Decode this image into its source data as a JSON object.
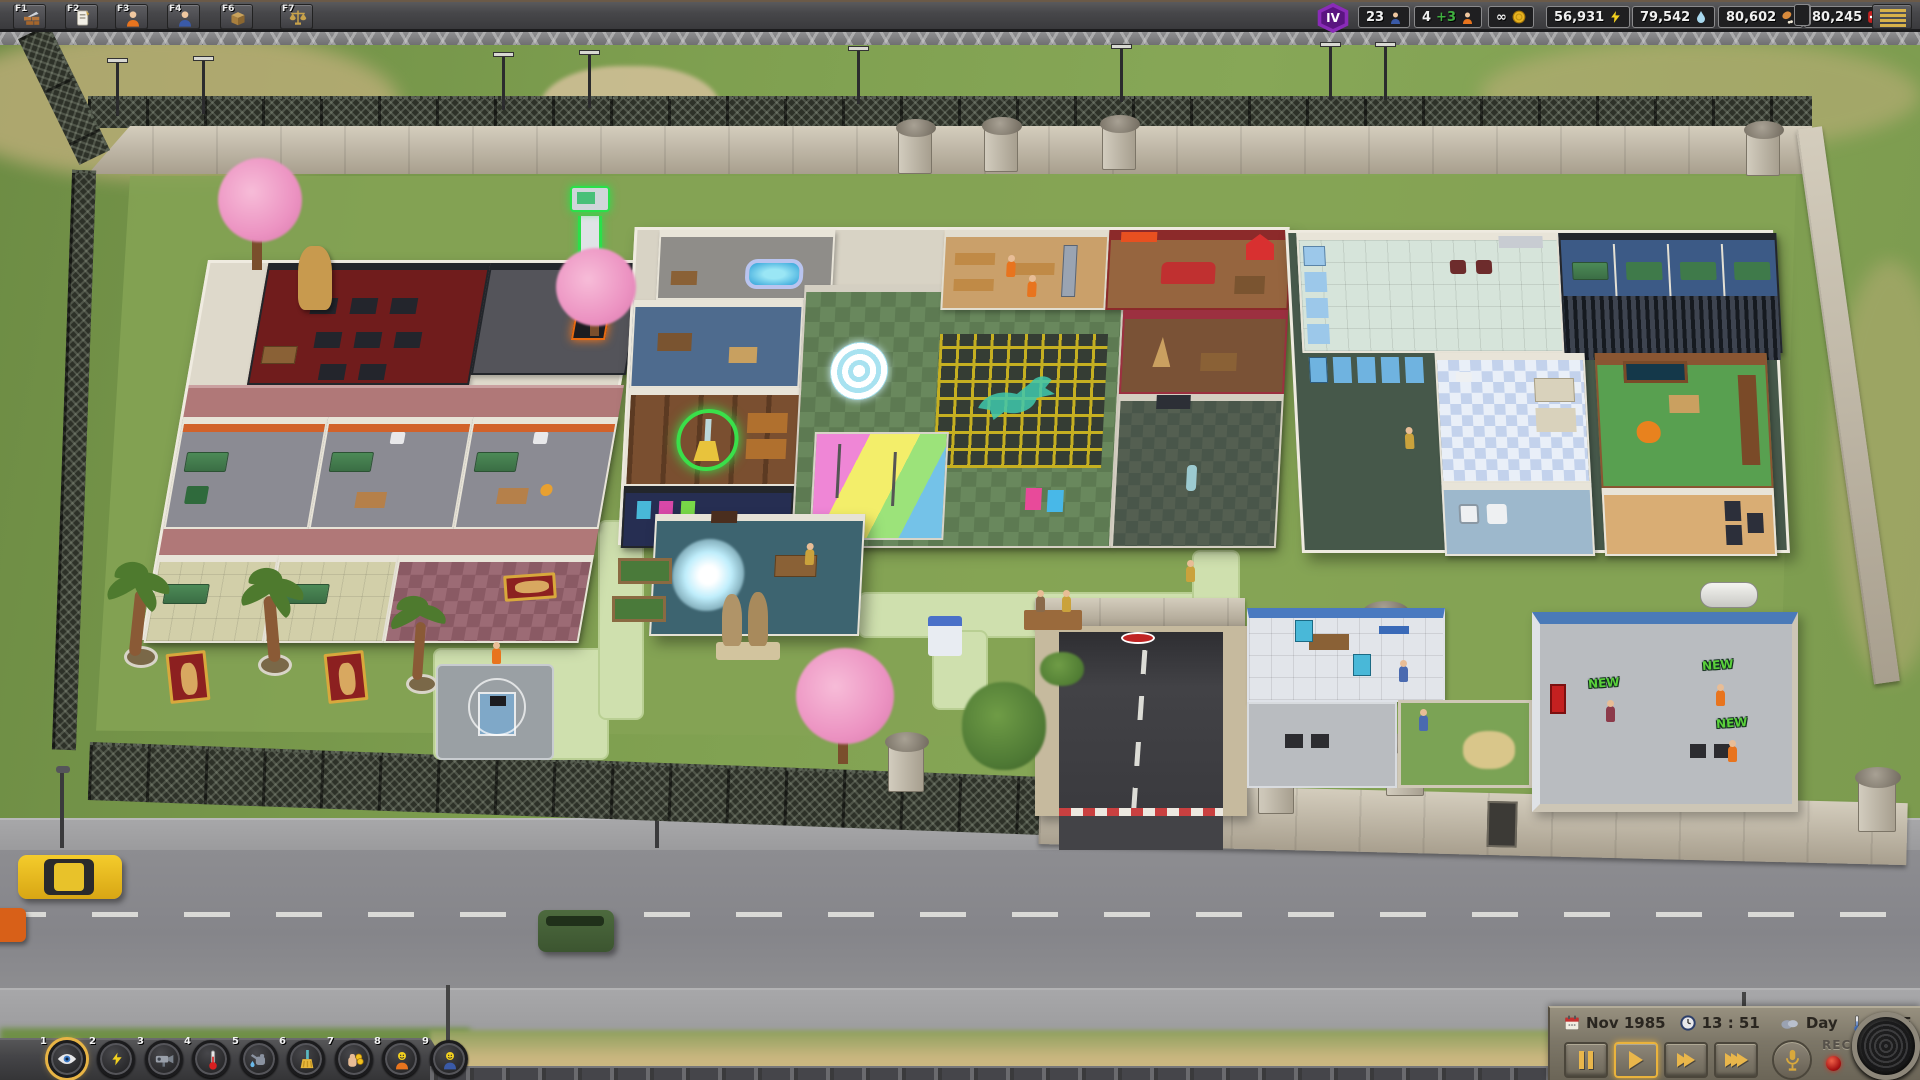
{
  "top_bar": {
    "hotkeys": [
      {
        "key": "F1",
        "icon": "build-wall-icon"
      },
      {
        "key": "F2",
        "icon": "contracts-icon"
      },
      {
        "key": "F3",
        "icon": "prisoners-icon"
      },
      {
        "key": "F4",
        "icon": "staff-icon"
      },
      {
        "key": "F6",
        "icon": "supplies-box-icon"
      },
      {
        "key": "F7",
        "icon": "justice-scales-icon"
      }
    ],
    "level_badge": "IV",
    "stats": [
      {
        "value": "23",
        "icon": "staff-count-icon"
      },
      {
        "value": "4",
        "bonus": "+3",
        "icon": "prisoner-count-icon"
      },
      {
        "value": "∞",
        "icon": "money-coin-icon"
      },
      {
        "value": "56,931",
        "icon": "power-bolt-icon"
      },
      {
        "value": "79,542",
        "icon": "water-drop-icon"
      },
      {
        "value": "80,602",
        "icon": "food-drumstick-icon"
      },
      {
        "value": "80,245",
        "icon": "medical-kit-icon"
      }
    ]
  },
  "bottom_bar": {
    "tools": [
      {
        "number": "1",
        "icon": "view-eye-icon",
        "active": true
      },
      {
        "number": "2",
        "icon": "power-overlay-icon",
        "active": false
      },
      {
        "number": "3",
        "icon": "camera-overlay-icon",
        "active": false
      },
      {
        "number": "4",
        "icon": "temperature-overlay-icon",
        "active": false
      },
      {
        "number": "5",
        "icon": "water-overlay-icon",
        "active": false
      },
      {
        "number": "6",
        "icon": "cleanliness-overlay-icon",
        "active": false
      },
      {
        "number": "7",
        "icon": "finance-overlay-icon",
        "active": false
      },
      {
        "number": "8",
        "icon": "prisoner-mood-icon",
        "active": false
      },
      {
        "number": "9",
        "icon": "staff-mood-icon",
        "active": false
      }
    ],
    "status": {
      "date": "Nov 1985",
      "time": "13 : 51",
      "daypart": "Day",
      "temperature": "68 °F"
    },
    "rec_label": "REC"
  },
  "scene": {
    "new_badge": "NEW"
  },
  "colors": {
    "accent_gold": "#e8b445",
    "level_purple": "#8a2bb8",
    "bonus_green": "#3fae3f",
    "rec_red": "#c01818",
    "grass": "#7fa050",
    "wall_stone": "#b5ae9e"
  }
}
